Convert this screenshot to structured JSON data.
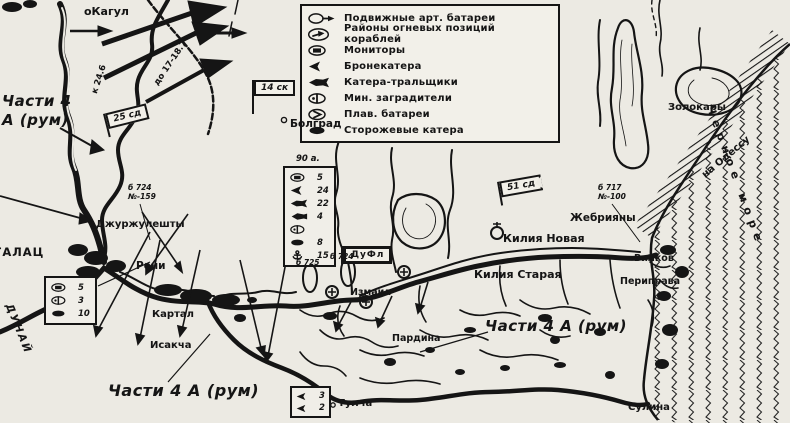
{
  "legend": {
    "items": [
      {
        "icon": "mobile-artillery-icon",
        "label": "Подвижные арт. батареи"
      },
      {
        "icon": "ship-firing-areas-icon",
        "label": "Районы огневых позиций кораблей"
      },
      {
        "icon": "monitor-icon",
        "label": "Мониторы"
      },
      {
        "icon": "armored-boat-icon",
        "label": "Бронекатера"
      },
      {
        "icon": "minesweeper-boat-icon",
        "label": "Катера-тральщики"
      },
      {
        "icon": "minelayer-icon",
        "label": "Мин. заградители"
      },
      {
        "icon": "floating-battery-icon",
        "label": "Плав. батареи"
      },
      {
        "icon": "patrol-boat-icon",
        "label": "Сторожевые катера"
      }
    ]
  },
  "flags": {
    "f25": "25 сд",
    "f14": "14 ск",
    "f51": "51 сд",
    "dufl": "ДуФл"
  },
  "units": {
    "left": "Части 4 А (рум)",
    "bottom": "Части 4 А (рум)",
    "right": "Части 4 А (рум)"
  },
  "places": {
    "kagul": "оКагул",
    "bolgrad": "Болград",
    "dzhurzhuleshty": "Джуржулешты",
    "reni": "Рени",
    "galats": "ГАЛАЦ",
    "dunay": "ДУНАЙ",
    "kartal": "Картал",
    "isakcha": "Исакча",
    "izmail": "Измаил",
    "pardina": "Пардина",
    "tulcha": "Тулча",
    "kiliya_novaya": "Килия Новая",
    "kiliya_staraya": "Килия Старая",
    "zhebriyany": "Жебрияны",
    "vilkov": "Вилков",
    "periprava": "Периправа",
    "zolokary": "Золокары",
    "sulina": "Сулина",
    "black_sea": "Черное море",
    "odessa_road": "на Одессу"
  },
  "annotations": {
    "date_advance": "до 17-18.7",
    "date_start": "к 24.6",
    "battery1_line1": "б 724",
    "battery1_line2": "№-159",
    "battery2": "б 725",
    "battery3": "б 724",
    "battery4_line1": "б 717",
    "battery4_line2": "№-100"
  },
  "force_boxes": {
    "left": {
      "rows": [
        {
          "icon": "monitor-icon",
          "value": "5"
        },
        {
          "icon": "minelayer-icon",
          "value": "3"
        },
        {
          "icon": "patrol-boat-icon",
          "value": "10"
        }
      ]
    },
    "center": {
      "label": "90 а.",
      "rows": [
        {
          "icon": "monitor-icon",
          "value": "5"
        },
        {
          "icon": "armored-boat-icon",
          "value": "24"
        },
        {
          "icon": "minesweeper-boat-icon",
          "value": "22"
        },
        {
          "icon": "gunboat-icon",
          "value": "4"
        },
        {
          "icon": "minelayer-icon",
          "value": ""
        },
        {
          "icon": "patrol-boat-icon",
          "value": "8"
        },
        {
          "icon": "anchor-icon",
          "value": "15"
        }
      ]
    },
    "tulcea": {
      "rows": [
        {
          "icon": "armored-boat-icon",
          "value": "3"
        },
        {
          "icon": "armored-boat-icon",
          "value": "2"
        }
      ]
    }
  }
}
